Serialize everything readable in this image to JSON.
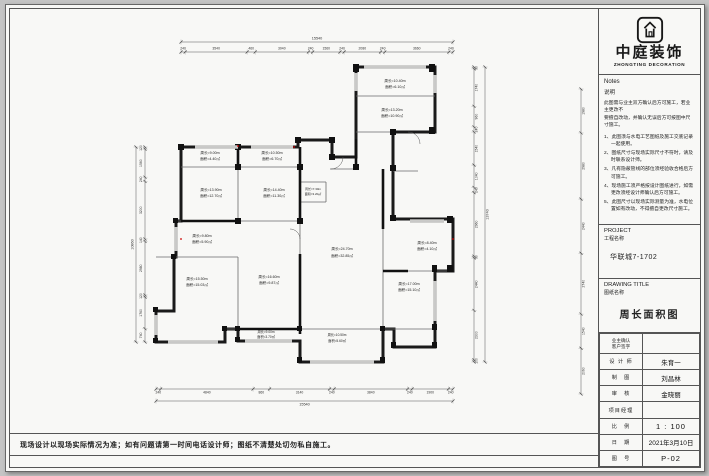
{
  "brand": {
    "name_cn": "中庭装饰",
    "name_en": "ZHONGTING DECORATION"
  },
  "notes": {
    "title": "Notes",
    "subtitle": "说明",
    "intro_lines": [
      "此图需与业主双方确认后方可施工，若业主更改不",
      "要擅自改动，并确认无误后方可按图中尺寸施工。"
    ],
    "items": [
      "1、此图须与水电工艺图纸及施工交底记录一起使用。",
      "2、图纸尺寸与现场实际尺寸不符时，请及时联系设计师。",
      "3、凡有隐蔽管线的部位须经验收合格后方可施工。",
      "4、现场施工须严格按设计图纸进行，如需更改须经设计师确认后方可施工。",
      "5、此图尺寸以现场实际测量为准，水电位置如有改动，不得擅自更改尺寸施工。"
    ]
  },
  "project": {
    "label_en": "PROJECT",
    "label_cn": "工程名称",
    "value": "华联城7-1702"
  },
  "drawing": {
    "label_en": "DRAWING  TITLE",
    "label_cn": "图纸名称",
    "value": "周长面积图"
  },
  "titleblock": {
    "rows": [
      {
        "label": "业主确认",
        "label2": "客户签字",
        "value": ""
      },
      {
        "label": "设 计 师",
        "value": "朱育一"
      },
      {
        "label": "制　图",
        "value": "刘昌林"
      },
      {
        "label": "审　核",
        "value": "金晓丽"
      },
      {
        "label": "项目经理",
        "value": ""
      },
      {
        "label": "比　例",
        "value": "1 : 100"
      },
      {
        "label": "日　期",
        "value": "2021年3月10日"
      },
      {
        "label": "图　号",
        "value": "P-02"
      }
    ]
  },
  "footer_note": "现场设计以现场实际情况为准；如有问题请第一时间电话设计师；图纸不清楚处切勿私自施工。",
  "plan": {
    "rooms": [
      {
        "id": "balcony-top",
        "line1": "周长=10.40m",
        "line2": "面积=6.10㎡"
      },
      {
        "id": "bedroom-top",
        "line1": "周长=13.20m",
        "line2": "面积=10.90㎡"
      },
      {
        "id": "bath-1",
        "line1": "周长=9.00m",
        "line2": "面积=4.40㎡"
      },
      {
        "id": "bath-2",
        "line1": "周长=10.50m",
        "line2": "面积=6.70㎡"
      },
      {
        "id": "bedroom-left",
        "line1": "周长=13.90m",
        "line2": "面积=12.70㎡"
      },
      {
        "id": "bedroom-middle",
        "line1": "周长=14.40m",
        "line2": "面积=11.30㎡"
      },
      {
        "id": "closet",
        "line1": "周长=7.30m",
        "line2": "面积=3.20㎡"
      },
      {
        "id": "entry",
        "line1": "周长=9.80m",
        "line2": "面积=5.90㎡"
      },
      {
        "id": "master-bedroom",
        "line1": "周长=15.50m",
        "line2": "面积=15.03㎡"
      },
      {
        "id": "study",
        "line1": "周长=16.60m",
        "line2": "面积=9.87㎡"
      },
      {
        "id": "living-room",
        "line1": "周长=24.70m",
        "line2": "面积=32.85㎡"
      },
      {
        "id": "bath-3",
        "line1": "周长=8.40m",
        "line2": "面积=4.10㎡"
      },
      {
        "id": "dining-room",
        "line1": "周长=17.00m",
        "line2": "面积=15.10㎡"
      },
      {
        "id": "balcony-bottom-1",
        "line1": "周长=9.00m",
        "line2": "面积=3.70㎡"
      },
      {
        "id": "balcony-bottom-2",
        "line1": "周长=10.50m",
        "line2": "面积=5.60㎡"
      }
    ],
    "dims": {
      "top_total": "15540",
      "top_segments": [
        "240",
        "3540",
        "460",
        "3040",
        "240",
        "1560",
        "240",
        "2080",
        "240",
        "3660",
        "240"
      ],
      "bottom_total": "15540",
      "bottom_segments": [
        "240",
        "4840",
        "860",
        "3140",
        "240",
        "3840",
        "240",
        "1900",
        "240"
      ],
      "left_total": "10860",
      "left_segments": [
        "120",
        "1560",
        "240",
        "3200",
        "140",
        "2980",
        "120",
        "1760",
        "740"
      ],
      "right_total": "13740",
      "right_segments": [
        "90",
        "1740",
        "960",
        "240",
        "1540",
        "1040",
        "240",
        "2960",
        "90",
        "2440",
        "2300",
        "100"
      ],
      "right_outer_segments": [
        "1980",
        "2980",
        "2440",
        "2740",
        "1540",
        "2060"
      ]
    }
  }
}
